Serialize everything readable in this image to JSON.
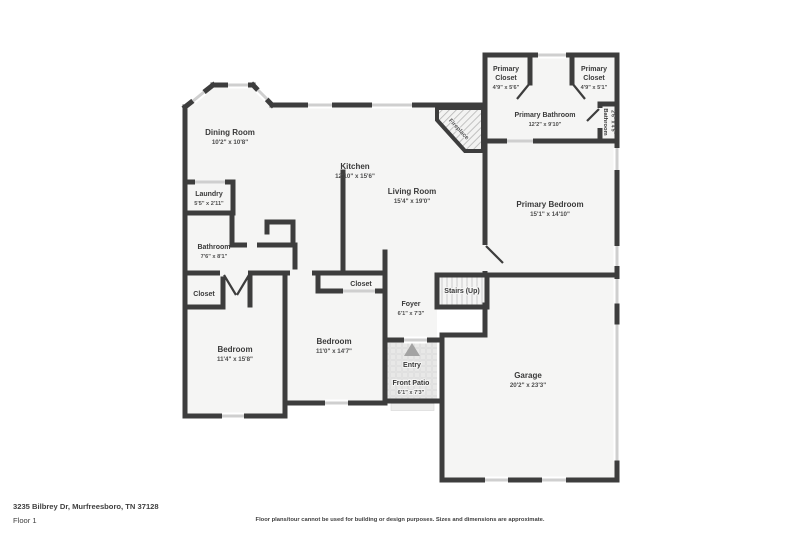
{
  "footer": {
    "address": "3235 Bilbrey Dr, Murfreesboro, TN 37128",
    "floor_label": "Floor 1",
    "disclaimer": "Floor plans/tour cannot be used for building or design purposes. Sizes and dimensions are approximate."
  },
  "colors": {
    "wall": "#3d3d3d",
    "floor": "#f5f5f4",
    "window_band": "#cfcfcf",
    "background": "#ffffff",
    "text": "#3a3a3a"
  },
  "rooms": [
    {
      "name": "Dining Room",
      "dims": "10'2\" x 10'8\""
    },
    {
      "name": "Kitchen",
      "dims": "12'10\" x 15'6\""
    },
    {
      "name": "Living Room",
      "dims": "15'4\" x 19'0\""
    },
    {
      "name": "Laundry",
      "dims": "5'5\" x 2'11\""
    },
    {
      "name": "Bathroom",
      "dims": "7'6\" x 8'1\""
    },
    {
      "name": "Primary Closet",
      "name_line1": "Primary",
      "name_line2": "Closet",
      "dims": "4'9\" x 5'6\""
    },
    {
      "name": "Primary Closet",
      "name_line1": "Primary",
      "name_line2": "Closet",
      "dims": "4'9\" x 5'1\""
    },
    {
      "name": "Primary Bathroom",
      "dims": "12'2\" x 9'10\""
    },
    {
      "name": "Bathroom",
      "dims": "2'6\" x 4'5\""
    },
    {
      "name": "Primary Bedroom",
      "dims": "15'1\" x 14'10\""
    },
    {
      "name": "Closet",
      "dims": ""
    },
    {
      "name": "Closet",
      "dims": ""
    },
    {
      "name": "Bedroom",
      "dims": "11'4\" x 15'8\""
    },
    {
      "name": "Bedroom",
      "dims": "11'0\" x 14'7\""
    },
    {
      "name": "Foyer",
      "dims": "6'1\" x 7'3\""
    },
    {
      "name": "Stairs (Up)",
      "dims": ""
    },
    {
      "name": "Entry",
      "dims": ""
    },
    {
      "name": "Front Patio",
      "dims": "6'1\" x 7'3\""
    },
    {
      "name": "Garage",
      "dims": "20'2\" x 23'3\""
    },
    {
      "name": "Fireplace",
      "dims": ""
    }
  ]
}
